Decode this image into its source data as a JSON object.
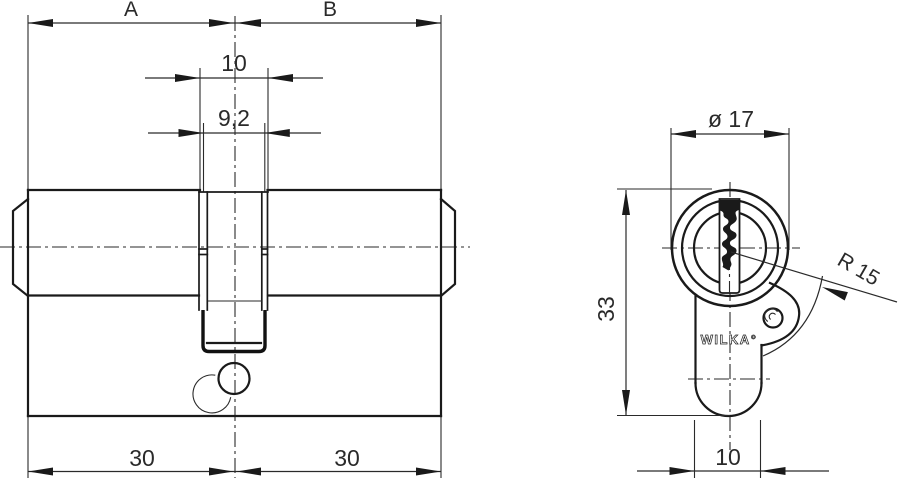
{
  "title": "Profile double cylinder lock technical drawing",
  "side_view": {
    "dim_half_a": "A",
    "dim_half_b": "B",
    "dim_cam_width": "10",
    "dim_cam_body_width": "9,2",
    "dim_length_left": "30",
    "dim_length_right": "30"
  },
  "end_view": {
    "dim_diameter": "ø 17",
    "dim_height": "33",
    "dim_cam_radius": "R 15",
    "dim_body_width": "10",
    "brand": "WILKA°"
  },
  "colors": {
    "line": "#1a1a1a",
    "dim_text": "#2a2a2a",
    "background": "#ffffff"
  }
}
